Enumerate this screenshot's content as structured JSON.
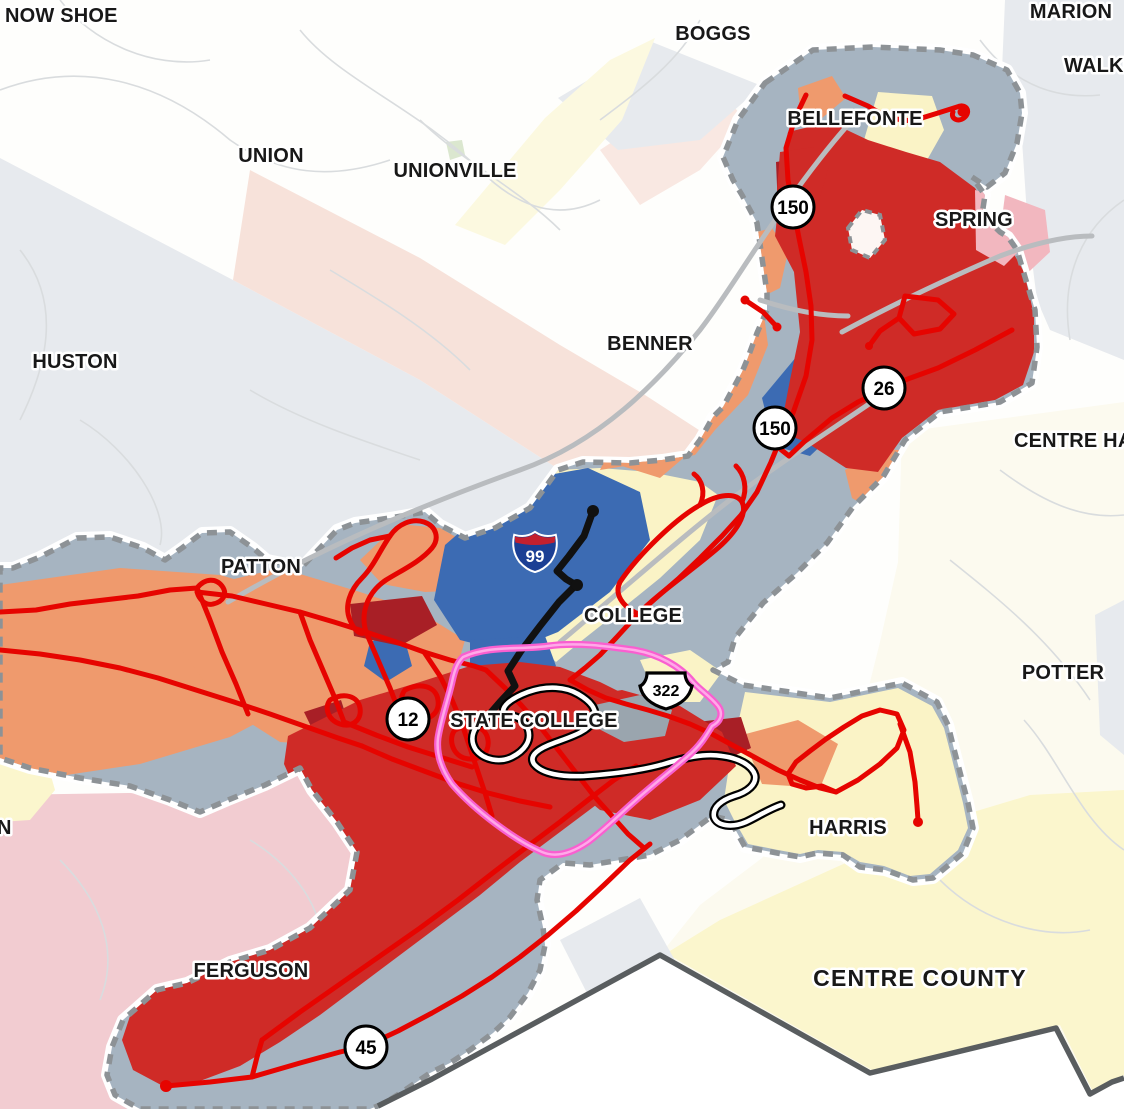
{
  "map": {
    "region_labels": [
      {
        "id": "snow-shoe",
        "text": "NOW SHOE"
      },
      {
        "id": "boggs",
        "text": "BOGGS"
      },
      {
        "id": "marion",
        "text": "MARION"
      },
      {
        "id": "walker",
        "text": "WALKE"
      },
      {
        "id": "union",
        "text": "UNION"
      },
      {
        "id": "unionville",
        "text": "UNIONVILLE"
      },
      {
        "id": "bellefonte",
        "text": "BELLEFONTE"
      },
      {
        "id": "spring",
        "text": "SPRING"
      },
      {
        "id": "huston",
        "text": "HUSTON"
      },
      {
        "id": "benner",
        "text": "BENNER"
      },
      {
        "id": "centre-hall",
        "text": "CENTRE HAL"
      },
      {
        "id": "patton",
        "text": "PATTON"
      },
      {
        "id": "college",
        "text": "COLLEGE"
      },
      {
        "id": "potter",
        "text": "POTTER"
      },
      {
        "id": "state-college",
        "text": "STATE COLLEGE"
      },
      {
        "id": "harris",
        "text": "HARRIS"
      },
      {
        "id": "ferguson",
        "text": "FERGUSON"
      },
      {
        "id": "halfmoon-fragment",
        "text": "N"
      }
    ],
    "county_label": {
      "text": "CENTRE COUNTY"
    },
    "shields": {
      "interstate": {
        "number": "99"
      },
      "us": {
        "number": "322"
      },
      "circles": [
        {
          "id": "pa-150-north",
          "number": "150"
        },
        {
          "id": "pa-26",
          "number": "26"
        },
        {
          "id": "pa-150-south",
          "number": "150"
        },
        {
          "id": "route-12",
          "number": "12"
        },
        {
          "id": "route-45",
          "number": "45"
        }
      ]
    },
    "colors": {
      "urban_base": "#a6b4c1",
      "zone_orange": "#ef9a6d",
      "zone_yellow": "#faf3c6",
      "zone_blue": "#3c6bb3",
      "zone_red": "#cf2b27",
      "zone_dark_red": "#a81f26",
      "zone_pink": "#f2b7bf",
      "zone_gray": "#9aa5ae",
      "route_red": "#e60400",
      "route_black": "#111111",
      "route_white": "#ffffff",
      "route_magenta": "#f95fd0",
      "boundary_dash": "#8d9296",
      "county_line": "#595d5f",
      "shade_gray": "#e7eaee",
      "shade_peach": "#f7e2da",
      "shade_peach_light": "#f9e8e2",
      "shade_pink": "#f2ccd1",
      "shade_yellow_pale": "#fcf9e0",
      "shade_yellow": "#fbf6cd",
      "shade_cream": "#fcfaef",
      "shade_green": "#dbe7cf",
      "road_faint": "#d9dcde",
      "road_main": "#b9bcbf",
      "road_inner": "#ffffff",
      "interstate_blue": "#1b3f94",
      "interstate_red": "#c3202f",
      "shield_fill": "#ffffff",
      "shield_border": "#000000"
    }
  }
}
